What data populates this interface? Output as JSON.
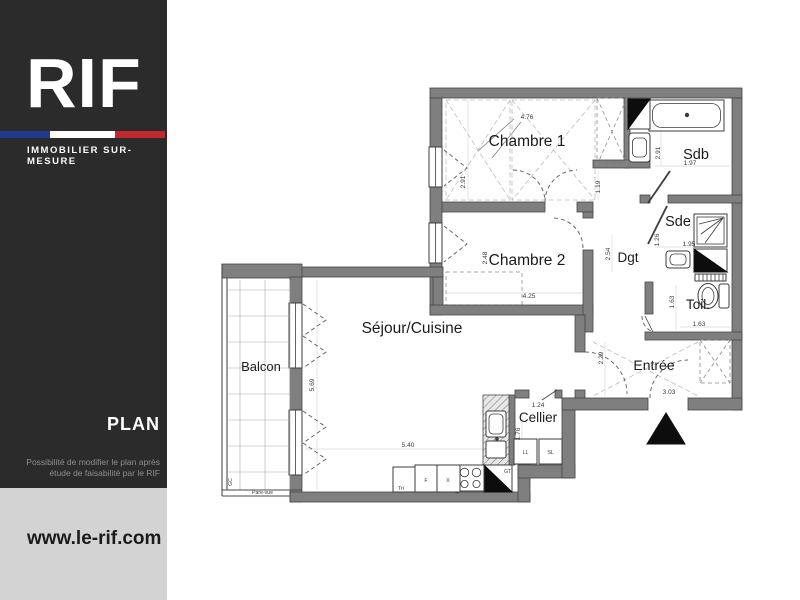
{
  "brand": {
    "logo": "RIF",
    "tagline": "IMMOBILIER  SUR-MESURE",
    "section_label": "PLAN",
    "disclaimer": [
      "Possibilité de modifier le plan après",
      "étude de faisabilité par le RIF"
    ],
    "website": "www.le-rif.com",
    "colors": {
      "sidebar_bg": "#2b2b2c",
      "footer_bg": "#d3d3d3",
      "flag_blue": "#22398c",
      "flag_red": "#c3282e",
      "wall_gray": "#7f7f7f"
    }
  },
  "plan": {
    "rooms": {
      "chambre1": {
        "label": "Chambre 1",
        "width_m": "4.76",
        "height_m": "2.91",
        "passage_m": "1.19"
      },
      "sdb": {
        "label": "Sdb",
        "height_m": "2.91",
        "width_m": "1.97"
      },
      "sde": {
        "label": "Sde",
        "width_m": "1.95",
        "height_m": "1.26"
      },
      "dgt": {
        "label": "Dgt",
        "height_m": "2.54"
      },
      "toil": {
        "label": "Toil.",
        "height_m": "1.63",
        "width_m": "1.63"
      },
      "chambre2": {
        "label": "Chambre 2",
        "height_m": "2.48",
        "width_m": "4.25"
      },
      "sejour": {
        "label": "Séjour/Cuisine",
        "height_m": "5.69",
        "width_m": "5.40"
      },
      "entree": {
        "label": "Entrée",
        "height_m": "2.29",
        "width_m": "3.03"
      },
      "cellier": {
        "label": "Cellier",
        "width_m": "1.24",
        "height_m": "1.76"
      },
      "balcon": {
        "label": "Balcon"
      }
    },
    "appliances": {
      "ll": "LL",
      "sl": "SL",
      "tri": "Tri",
      "fridge": "F",
      "x": "X",
      "gt": "GT"
    },
    "annotations": {
      "pare_vue": "Pare-vue",
      "garde_corps": "GC"
    }
  }
}
